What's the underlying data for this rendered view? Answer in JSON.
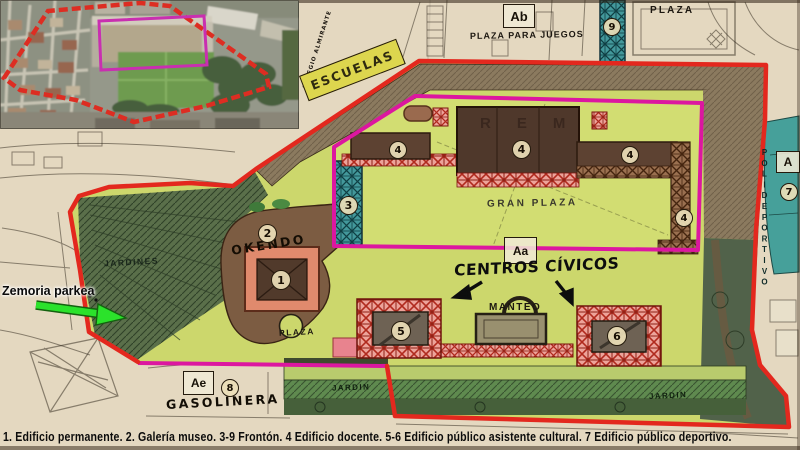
{
  "colors": {
    "site_boundary_red": "#e3281e",
    "zone_outline_magenta": "#dc17a0",
    "pointer_arrow_green": "#2be22b"
  },
  "map": {
    "labels": {
      "plaza_top": "PLAZA",
      "plaza_para_juegos": "PLAZA PARA JUEGOS",
      "escuelas": "ESCUELAS",
      "colegio_almirante": "COLEGIO ALMIRANTE",
      "gran_plaza": "GRAN PLAZA",
      "centros_civicos": "CENTROS CÍVICOS",
      "manteo": "MANTEO",
      "okendo": "OKENDO",
      "plaza_small": "PLAZA",
      "jardines": "JARDINES",
      "jardin_left": "JARDIN",
      "jardin_right": "JARDIN",
      "gasolinera": "GASOLINERA",
      "polideportivo": "POLIDEPORTIVO",
      "rem_faint": "REM"
    },
    "zone_boxes": {
      "ab": "Ab",
      "aa": "Aa",
      "ae": "Ae",
      "a": "A"
    },
    "markers": {
      "n1": "1",
      "n2": "2",
      "n3": "3",
      "n4": "4",
      "n5": "5",
      "n6": "6",
      "n7": "7",
      "n8": "8",
      "n9": "9"
    }
  },
  "annotation": {
    "zemoria": "Zemoria parkea"
  },
  "caption": "1. Edificio permanente. 2. Galería museo. 3-9 Frontón. 4 Edificio docente. 5-6 Edificio público asistente cultural. 7 Edificio público deportivo."
}
